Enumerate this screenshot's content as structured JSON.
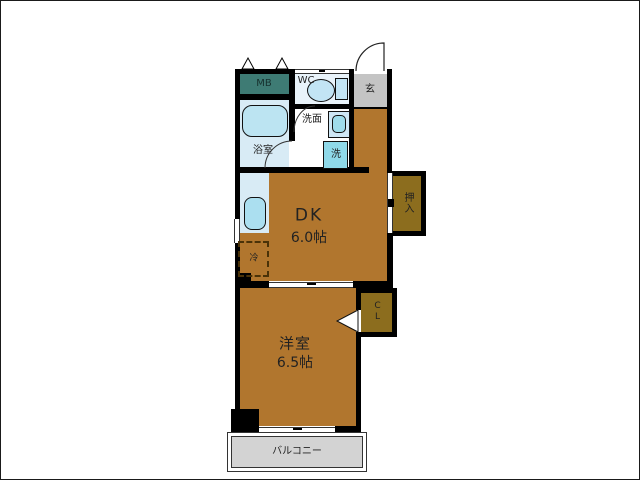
{
  "rooms": {
    "meter_box": {
      "label": "MB"
    },
    "toilet_room": {
      "label": "WC"
    },
    "entrance": {
      "label": "玄"
    },
    "bathroom": {
      "label": "浴室"
    },
    "washroom": {
      "label": "洗面"
    },
    "washing_machine": {
      "label": "洗"
    },
    "refrigerator": {
      "label": "冷"
    },
    "dining_kitchen": {
      "label": "DK",
      "size": "6.0帖"
    },
    "oshiire_closet": {
      "label": "押入"
    },
    "western_room": {
      "label": "洋室",
      "size": "6.5帖"
    },
    "closet": {
      "label": "CL"
    },
    "balcony": {
      "label": "バルコニー"
    }
  },
  "colors": {
    "wall": "#000000",
    "room_floor": "#B1762E",
    "closet_floor": "#8C6D1E",
    "meter_box": "#3E7B74",
    "bathroom_floor": "#D8EBF5",
    "wc_floor": "#E9F3FA",
    "fixture_fill": "#BCE4F2",
    "washer_fill": "#8FD9E9",
    "entrance_floor": "#C4C4C4",
    "balcony_floor": "#D3D3D3"
  }
}
